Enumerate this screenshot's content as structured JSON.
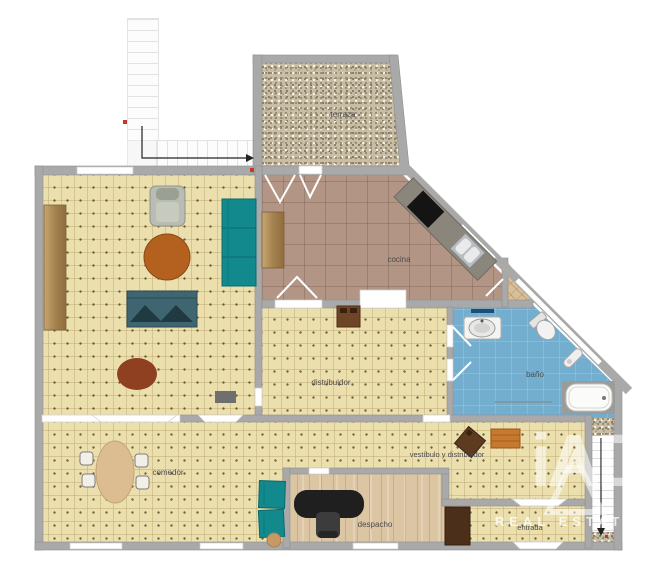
{
  "rooms": {
    "terraza": {
      "label": "terraza"
    },
    "cocina": {
      "label": "cocina"
    },
    "distribuidor": {
      "label": "distribuidor"
    },
    "bano": {
      "label": "baño"
    },
    "comedor": {
      "label": "comedor"
    },
    "despacho": {
      "label": "despacho"
    },
    "vestibulo": {
      "label": "vestíbulo y distribuidor"
    },
    "entrada": {
      "label": "entrada"
    }
  },
  "watermark": {
    "logo": "iAD",
    "text": "REAL ESTATE"
  },
  "colors": {
    "wall": "#a9a9a9",
    "carpet": "#ecdfae",
    "kitchen_floor": "#b29584",
    "bath_floor": "#74aecf",
    "office_floor": "#dbc5a3",
    "gravel": "#c8bda6",
    "sofa_teal": "#12898d",
    "sofa_slate": "#3f6570",
    "table_brown": "#b4611f",
    "rug_brown": "#8e4020",
    "desk_black": "#1f1f1f",
    "terrace_chair": "#bd6175",
    "arrow": "#222222",
    "marker_red": "#c0392b"
  },
  "furniture": [
    {
      "name": "upper-stairs"
    },
    {
      "name": "terrace-bush"
    },
    {
      "name": "terrace-chairs"
    },
    {
      "name": "kitchen-counter"
    },
    {
      "name": "cooktop"
    },
    {
      "name": "kitchen-sink"
    },
    {
      "name": "kitchen-table"
    },
    {
      "name": "sideboard"
    },
    {
      "name": "armchair"
    },
    {
      "name": "teal-sofa"
    },
    {
      "name": "slate-sofa"
    },
    {
      "name": "round-table"
    },
    {
      "name": "oval-rug"
    },
    {
      "name": "console-table"
    },
    {
      "name": "bath-vanity"
    },
    {
      "name": "toilet"
    },
    {
      "name": "bathtub"
    },
    {
      "name": "dining-table"
    },
    {
      "name": "dining-chairs"
    },
    {
      "name": "teal-chairs"
    },
    {
      "name": "office-desk"
    },
    {
      "name": "office-chair"
    },
    {
      "name": "hall-table"
    },
    {
      "name": "hall-rug"
    },
    {
      "name": "entry-cabinet"
    },
    {
      "name": "entry-stairs"
    }
  ]
}
